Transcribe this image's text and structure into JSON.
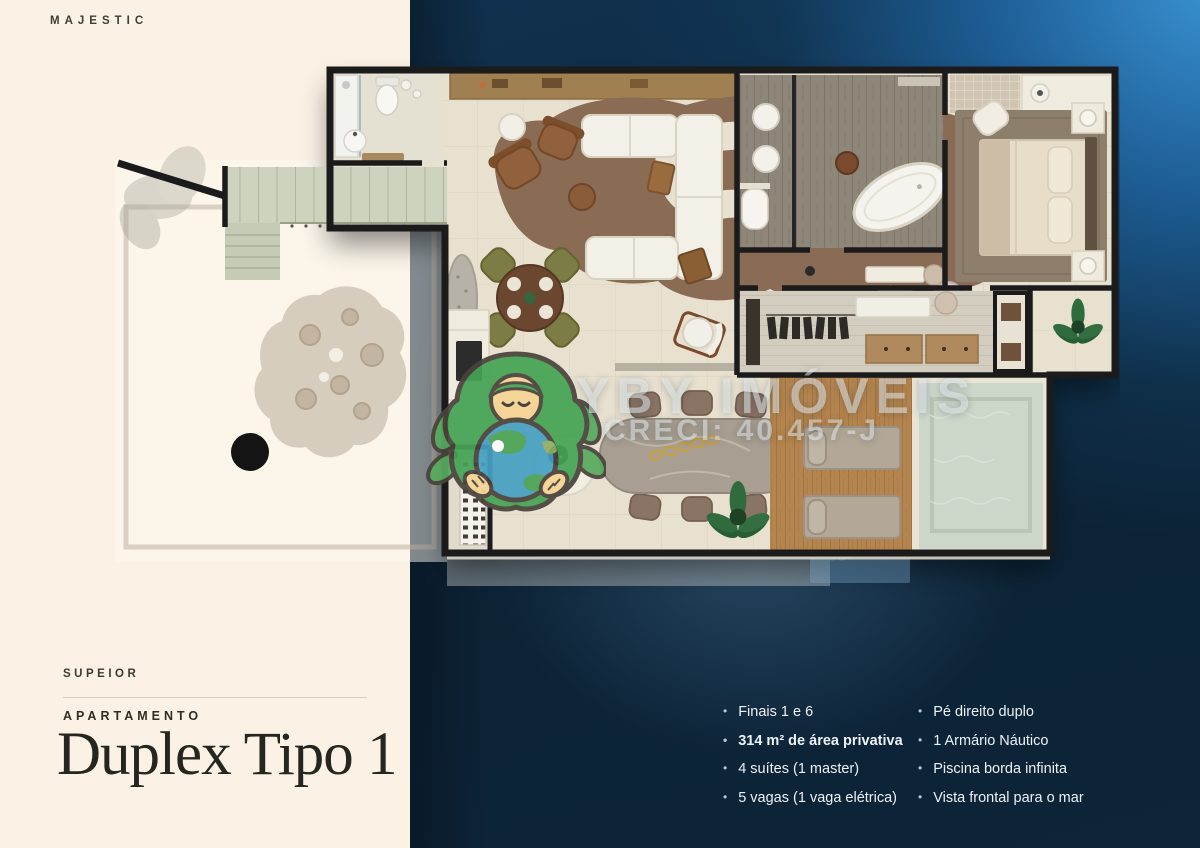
{
  "brand": {
    "logo_text": "MAJESTIC"
  },
  "unit": {
    "eyebrow": "SUPEIOR",
    "category": "APARTAMENTO",
    "title": "Duplex Tipo 1"
  },
  "features": {
    "column_1": [
      {
        "text": "Finais 1 e 6",
        "bold": false
      },
      {
        "text": "314 m² de área privativa",
        "bold": true
      },
      {
        "text": "4 suítes (1 master)",
        "bold": false
      },
      {
        "text": "5 vagas (1 vaga elétrica)",
        "bold": false
      }
    ],
    "column_2": [
      {
        "text": "Pé direito duplo",
        "bold": false
      },
      {
        "text": "1 Armário Náutico",
        "bold": false
      },
      {
        "text": "Piscina borda infinita",
        "bold": false
      },
      {
        "text": "Vista frontal para o mar",
        "bold": false
      }
    ]
  },
  "watermark": {
    "name": "YBY IMÓVEIS",
    "license": "CRECI: 40.457-J",
    "mascot": "earth-hug-mascot-icon"
  },
  "floorplan": {
    "kind": "duplex-apartment-top-view-render",
    "elements": [
      "terrace",
      "stairs",
      "garden-patch",
      "small-bathroom",
      "living-room",
      "organic-rug",
      "sectional-sofa",
      "armchairs",
      "round-dining-table",
      "stone-console",
      "master-bathroom",
      "freestanding-bathtub",
      "double-sinks",
      "toilet",
      "master-bedroom",
      "bed",
      "nightstands",
      "closet",
      "wardrobe-racks",
      "corridor",
      "kitchen-column",
      "wine-rack",
      "stone-dining-table",
      "side-table",
      "plants",
      "wood-deck",
      "sun-loungers",
      "infinity-pool",
      "balcony"
    ]
  },
  "colors": {
    "cream_panel": "#fbf2e5",
    "navy_base": "#0d2438",
    "navy_highlight": "#3a95d6",
    "floor_beige": "#e8e1d0",
    "wall_dark": "#1b1b1b",
    "rug_brown": "#8a6b54",
    "bath_wood": "#8d8679",
    "deck_wood": "#b5854f",
    "pool_water": "#ccd7ca",
    "stair_marble": "#ced3c0",
    "mascot_green": "#45a455",
    "mascot_skin": "#f6d493",
    "earth_blue": "#46a0c2"
  }
}
